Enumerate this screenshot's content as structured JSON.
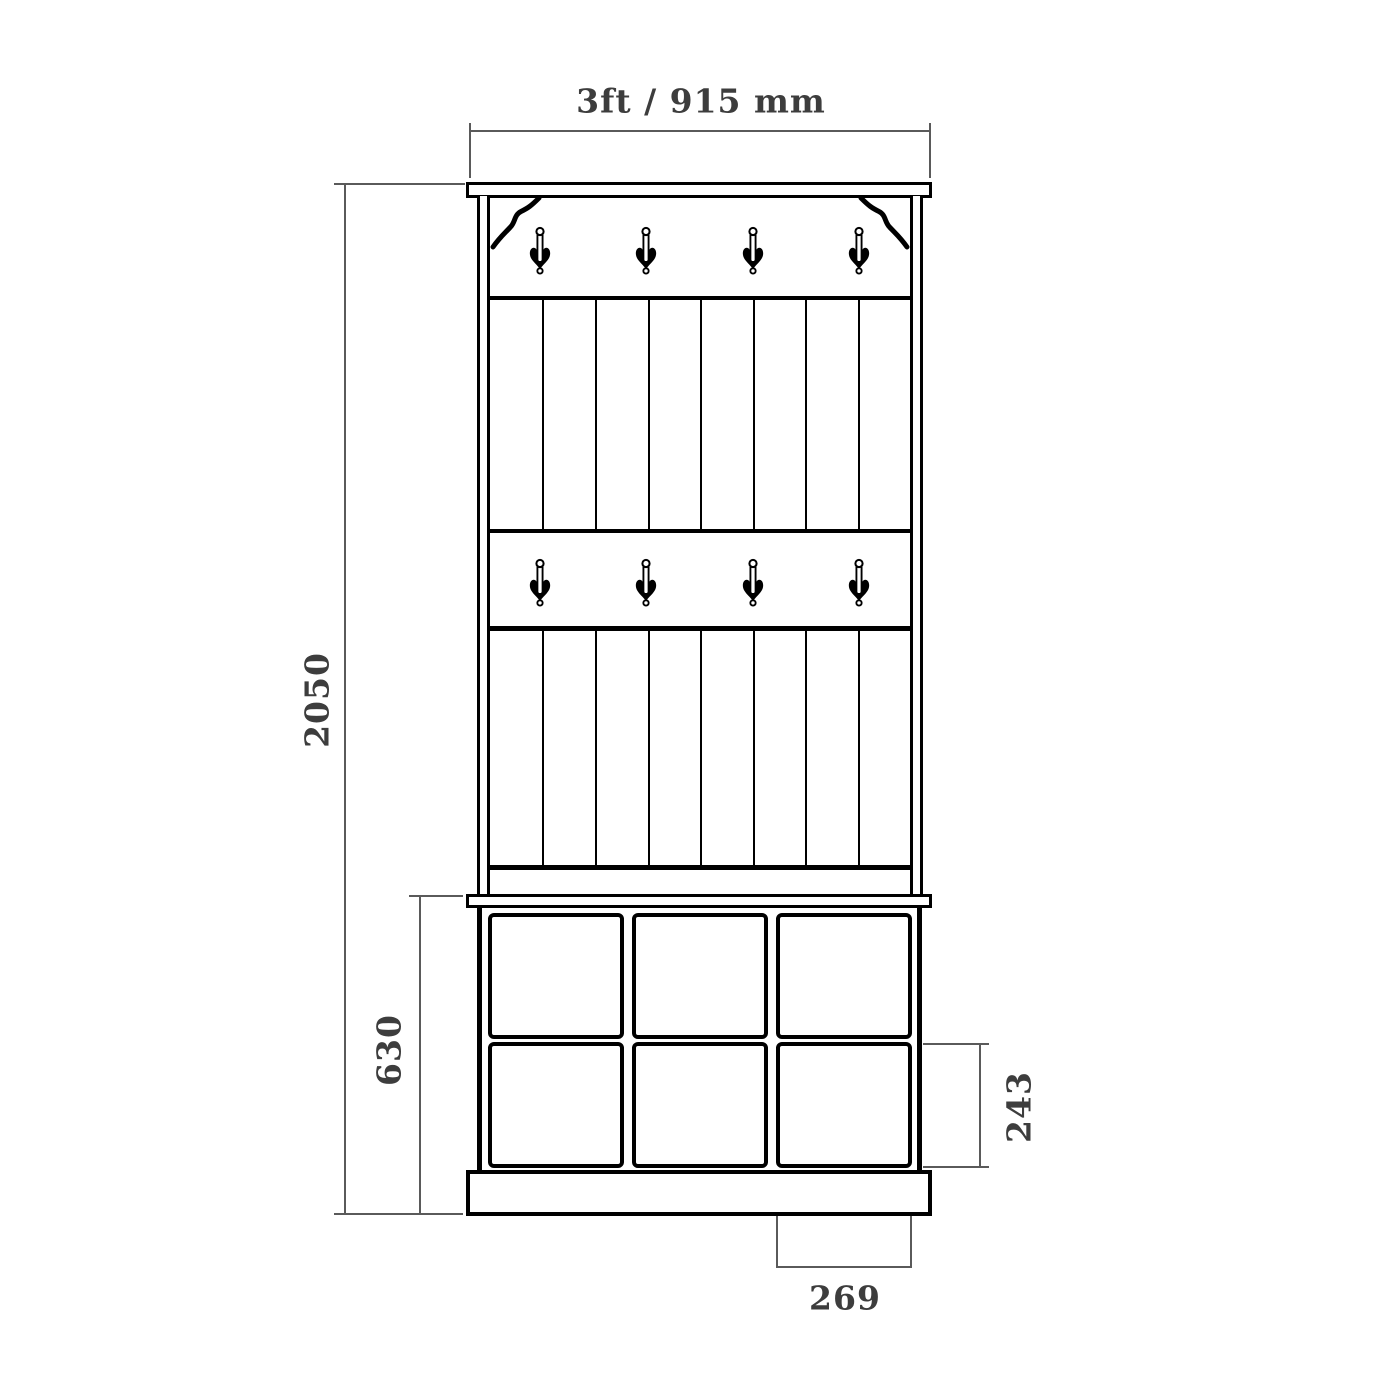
{
  "drawing": {
    "type": "furniture-dimension-diagram",
    "subject": "hall tree coat rack with panelled back, two hook rails, bench and 3x2 shoe cubbies",
    "hook_rows": 2,
    "hooks_per_row": 4,
    "panel_boards": 8,
    "cubby_columns": 3,
    "cubby_rows": 2
  },
  "dimensions": {
    "overall_width": {
      "label": "3ft / 915 mm",
      "orientation": "horizontal",
      "position": "top"
    },
    "overall_height": {
      "label": "2050",
      "orientation": "vertical",
      "position": "left"
    },
    "base_height": {
      "label": "630",
      "orientation": "vertical",
      "position": "left-inner"
    },
    "cubby_height": {
      "label": "243",
      "orientation": "vertical",
      "position": "right"
    },
    "cubby_width": {
      "label": "269",
      "orientation": "horizontal",
      "position": "bottom"
    }
  },
  "colors": {
    "outline": "#000000",
    "dimension_line": "#5a5a5a",
    "dimension_text": "#3d3d3d",
    "background": "#ffffff"
  }
}
